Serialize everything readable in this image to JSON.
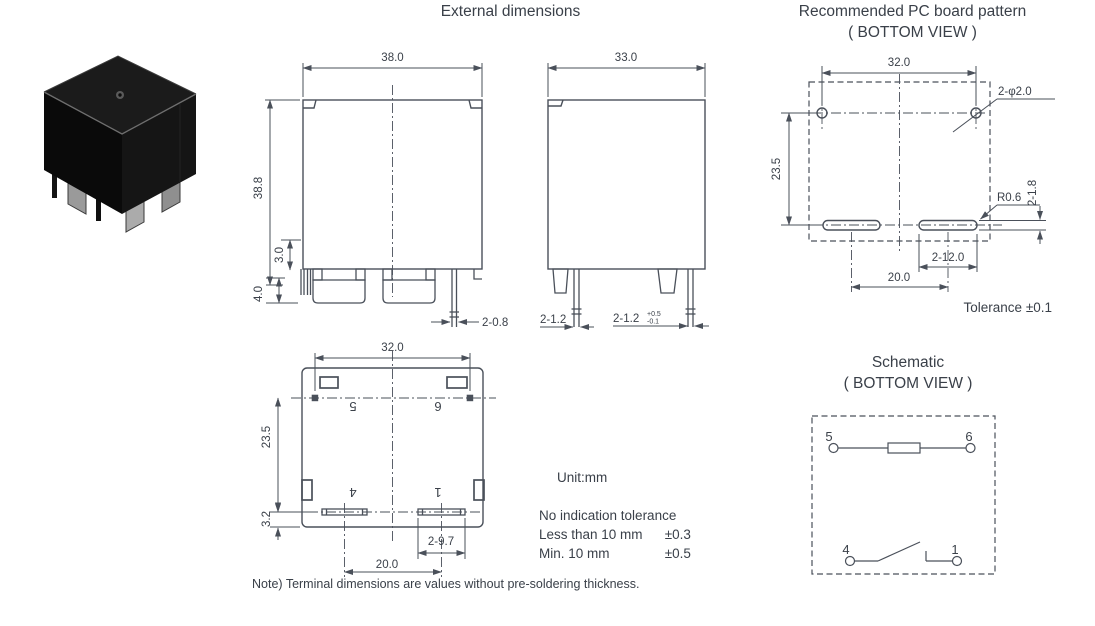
{
  "titles": {
    "external": "External dimensions",
    "pcb_line1": "Recommended PC board pattern",
    "pcb_line2": "( BOTTOM VIEW )",
    "schematic_line1": "Schematic",
    "schematic_line2": "( BOTTOM VIEW )"
  },
  "front_view": {
    "width": "38.0",
    "height": "38.8",
    "standoff": "3.0",
    "terminal_length": "4.0",
    "pin_dim": "2-0.8"
  },
  "side_view": {
    "width": "33.0",
    "pin_left": "2-1.2",
    "pin_right": "2-1.2",
    "tol_plus": "+0.5",
    "tol_minus": "-0.1"
  },
  "bottom_view": {
    "width": "32.0",
    "height": "23.5",
    "tab_offset": "3.2",
    "tab_dim": "2-9.7",
    "pitch": "20.0",
    "pin5": "5",
    "pin6": "6",
    "pin4": "4",
    "pin1": "1"
  },
  "pcb_pattern": {
    "width": "32.0",
    "height": "23.5",
    "holes": "2-φ2.0",
    "radius": "R0.6",
    "slot_width": "2-1.8",
    "slot_length": "2-12.0",
    "pitch": "20.0",
    "tolerance": "Tolerance ±0.1"
  },
  "schematic": {
    "pin5": "5",
    "pin6": "6",
    "pin4": "4",
    "pin1": "1"
  },
  "notes": {
    "unit": "Unit:mm",
    "tol_title": "No indication tolerance",
    "tol_row1_label": "Less than 10 mm",
    "tol_row1_value": "±0.3",
    "tol_row2_label": "Min. 10 mm",
    "tol_row2_value": "±0.5",
    "footnote": "Note) Terminal dimensions are values without pre-soldering thickness."
  }
}
